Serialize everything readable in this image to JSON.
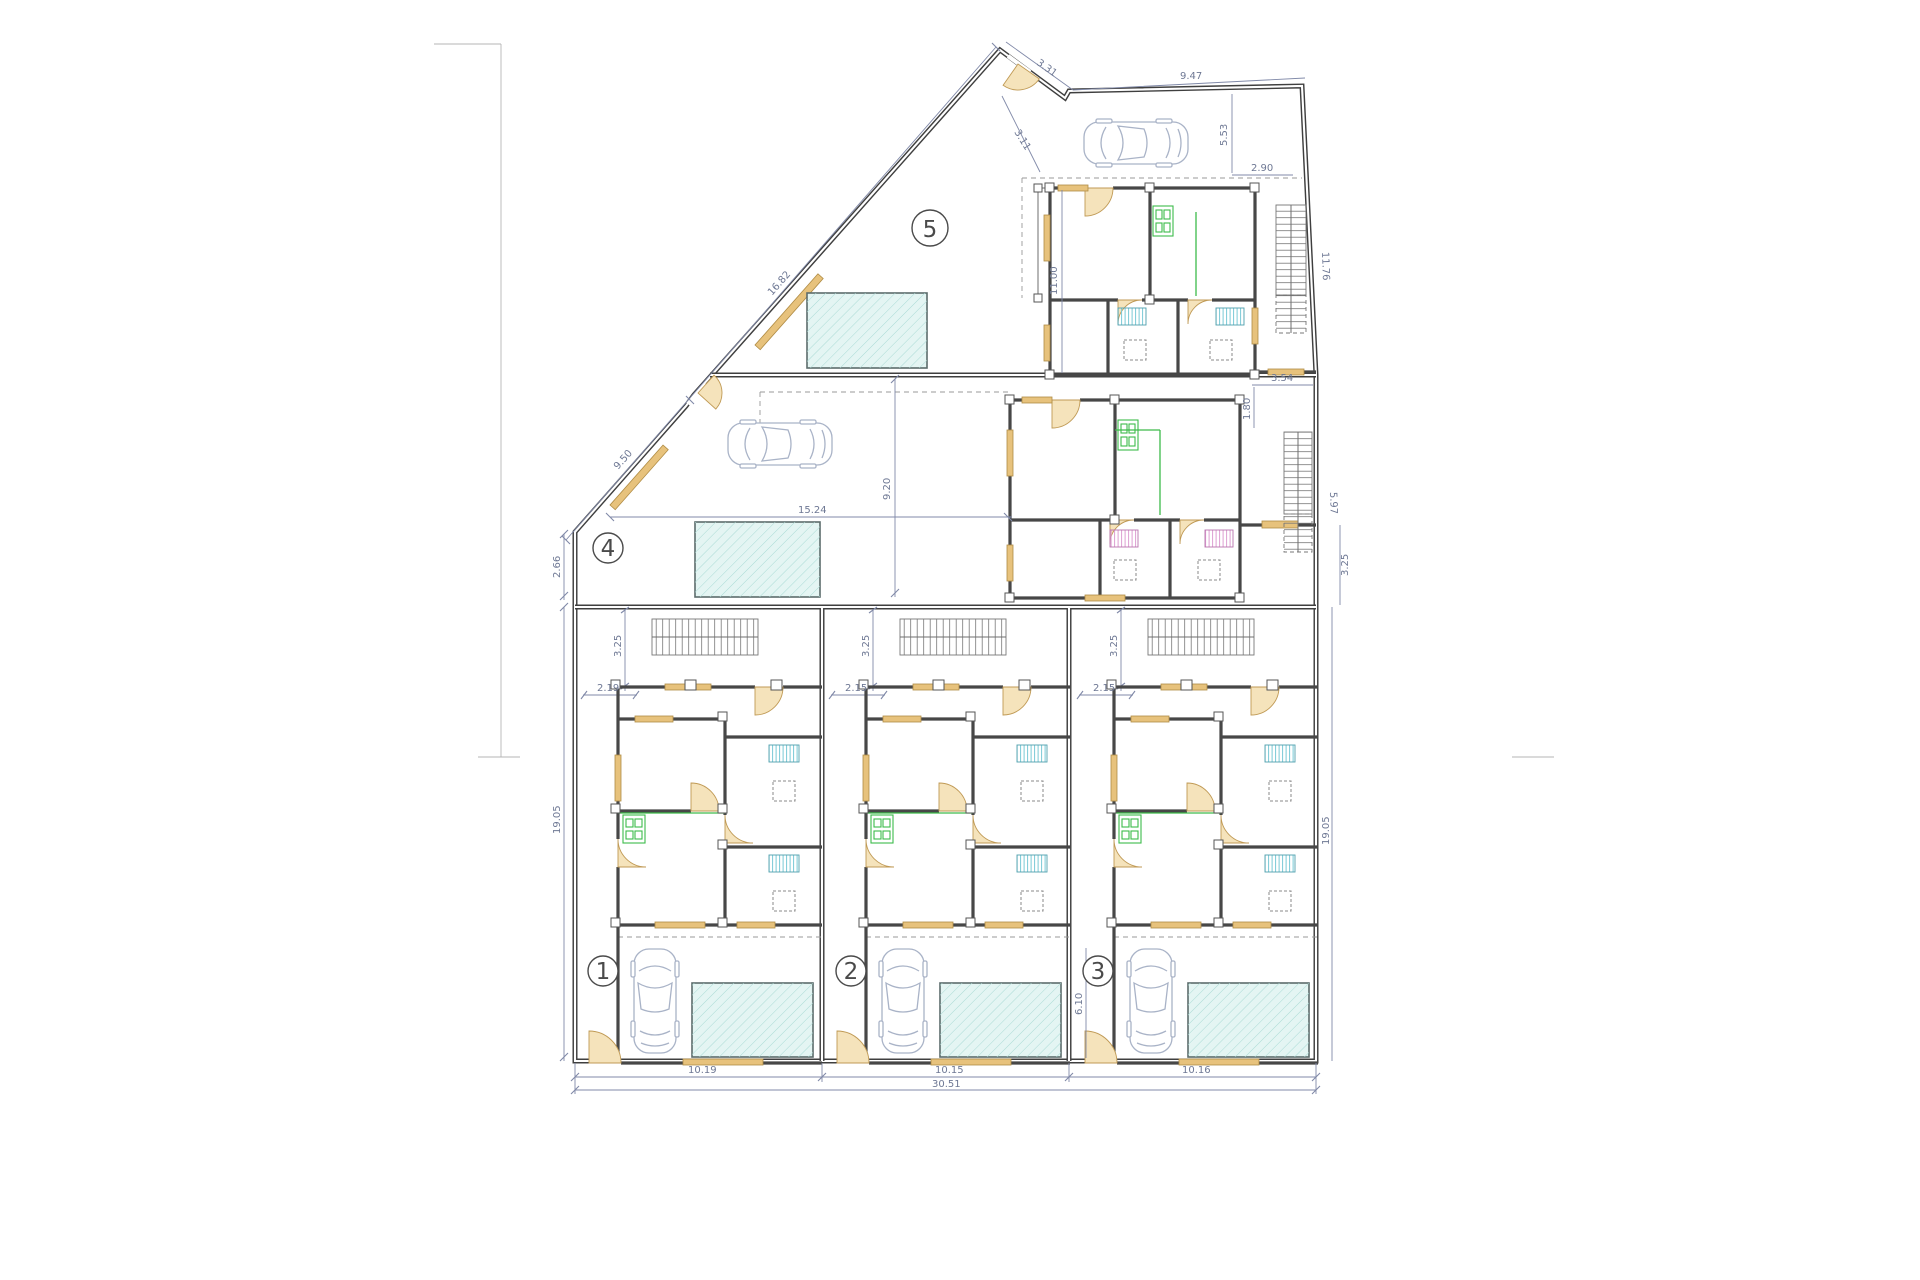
{
  "colors": {
    "wall": "#474747",
    "dimension": "#8089a8",
    "pool_fill": "#e4f5f3",
    "pool_hatch": "#aadbd5",
    "wood_lintel": "#e7c27c",
    "kitchen_green": "#3dbb4a",
    "fixture_cyan": "#79c9d6",
    "fixture_pink": "#dd9ed2",
    "car_outline": "#a9b3c7"
  },
  "dims": {
    "apex_wall": "3.31",
    "street_top": "9.47",
    "apex_inner": "3.11",
    "diag_upper": "16.82",
    "diag_lower": "9.50",
    "right_top_v": "5.53",
    "right_top_h": "2.90",
    "stairs5_edge": "11.76",
    "gap_h": "3.54",
    "gap_v": "1.80",
    "left_small": "2.66",
    "stairs4_edge": "5.97",
    "right_small": "3.25"
  },
  "units": [
    {
      "label": "1",
      "porch_depth": "3.25",
      "entry_width": "2.19",
      "frontage": "10.19"
    },
    {
      "label": "2",
      "porch_depth": "3.25",
      "entry_width": "2.15",
      "frontage": "10.15"
    },
    {
      "label": "3",
      "porch_depth": "3.25",
      "entry_width": "2.15",
      "frontage": "10.16",
      "court_depth": "6.10"
    },
    {
      "label": "4",
      "terrace_width": "15.24",
      "terrace_depth": "9.20"
    },
    {
      "label": "5",
      "house_depth": "11.00"
    }
  ],
  "site": {
    "left_depth": "19.05",
    "right_depth": "19.05",
    "total_frontage": "30.51"
  }
}
